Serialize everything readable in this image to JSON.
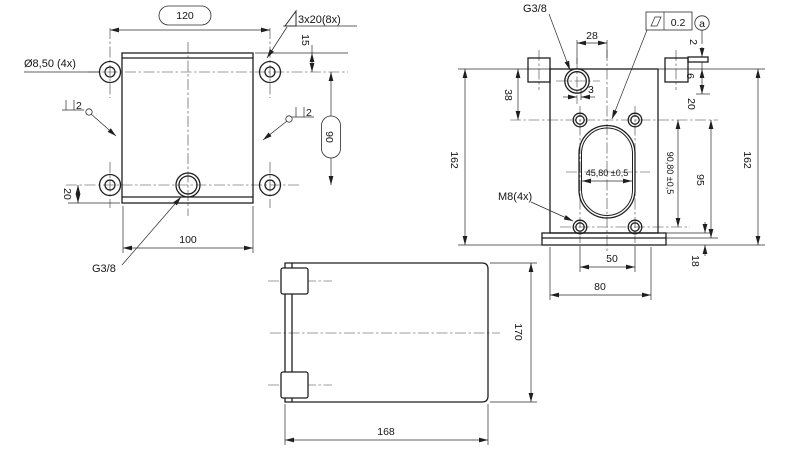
{
  "meta": {
    "background": "#ffffff",
    "line_color": "#1f1f1f"
  },
  "top_view": {
    "ref_width": "120",
    "chamfer_note": "3x20(8x)",
    "dim_15": "15",
    "hole_diameter": "Ø8,50 (4x)",
    "perp_left": "2",
    "perp_right": "2",
    "ref_height": "90",
    "dim_20": "20",
    "dim_100": "100",
    "thread_label": "G3/8"
  },
  "front_view": {
    "thread_label": "G3/8",
    "dim_28": "28",
    "dim_38": "38",
    "dim_3": "3",
    "dim_162_left": "162",
    "bolt_note": "M8(4x)",
    "slot_width": "45,80 ±0,5",
    "bolt_span_v": "90,80 ±0,5",
    "dim_95": "95",
    "dim_162_right": "162",
    "dim_20": "20",
    "dim_2": "2",
    "dim_6": "6",
    "dim_18": "18",
    "dim_50": "50",
    "dim_80": "80",
    "flatness_value": "0.2",
    "datum_label": "a"
  },
  "side_view": {
    "dim_168": "168",
    "dim_170": "170"
  }
}
